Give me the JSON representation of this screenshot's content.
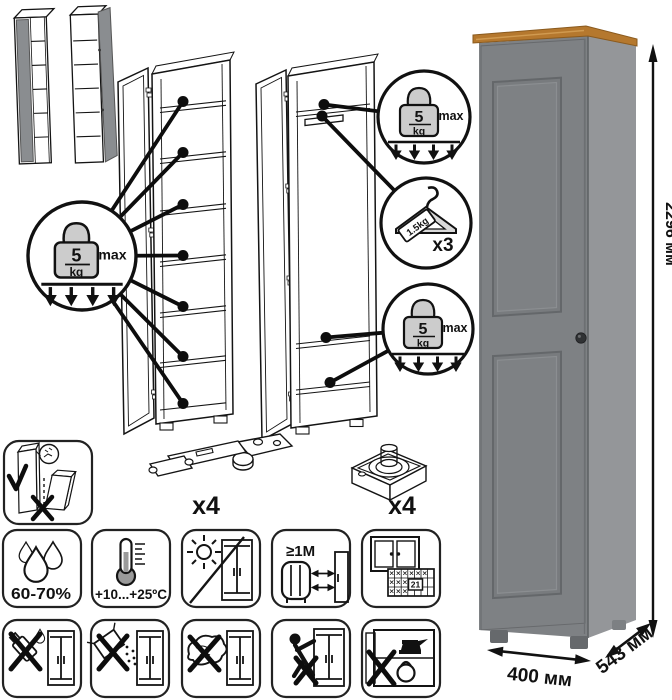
{
  "badges": {
    "shelf_left": {
      "value": "5",
      "unit": "kg",
      "limit": "max"
    },
    "shelf_top": {
      "value": "5",
      "unit": "kg",
      "limit": "max"
    },
    "shelf_bottom": {
      "value": "5",
      "unit": "kg",
      "limit": "max"
    },
    "hanger": {
      "tag": "1.5kg",
      "multiplier": "x3"
    }
  },
  "dimensions": {
    "height": "2296 мм",
    "width": "400 мм",
    "depth": "543 мм"
  },
  "hardware": {
    "hinge_quantity": "x4",
    "foot_quantity": "x4"
  },
  "care": {
    "humidity_range": "60-70%",
    "temperature_range": "+10...+25ºC",
    "heat_distance": "≥1M",
    "calendar_day": "21"
  },
  "colors": {
    "wardrobe_front": "#7e8184",
    "wardrobe_side": "#949699",
    "wood_top": "#b5782e",
    "knob": "#303234",
    "weight_fill": "#cccccc",
    "hanger_fill": "#d9d9d9",
    "mini_door": "#8a8d90",
    "outline": "#111111"
  }
}
